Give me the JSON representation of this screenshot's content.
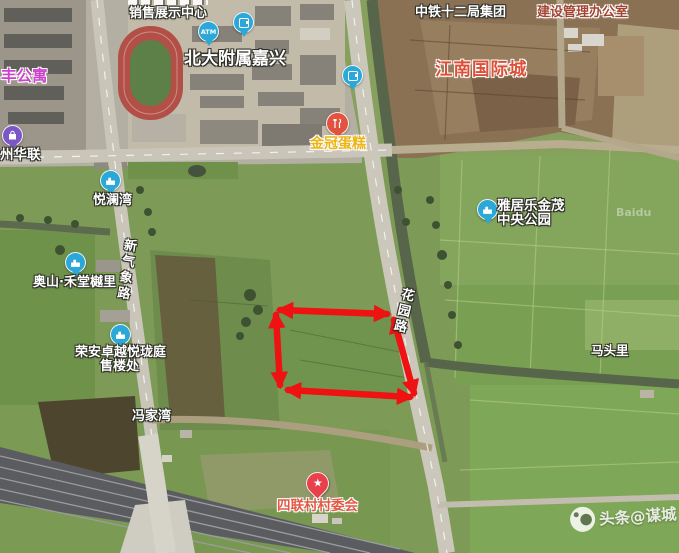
{
  "map": {
    "pois": {
      "sales_center": "销售展示中心",
      "school": "北大附属嘉兴",
      "railway_group": "中铁十二局集团",
      "management_office": "建设管理办公室",
      "jiangnan_city": "江南国际城",
      "apartment": "丰公寓",
      "hualian": "州华联",
      "yuelanwan": "悦澜湾",
      "aoshan": "奥山·禾堂樾里",
      "rongan_line1": "荣安卓越悦珑庭",
      "rongan_line2": "售楼处",
      "cake_shop": "金冠蛋糕",
      "yajule_line1": "雅居乐金茂",
      "yajule_line2": "中央公园",
      "fengjiawan": "冯家湾",
      "matouli": "马头里",
      "village_committee": "四联村村委会"
    },
    "roads": {
      "xinqixiang": "新气象路",
      "huayuan": "花园路"
    },
    "atm_label": "ATM",
    "tile_credit": "Baidu"
  },
  "annotation": {
    "shape": "quadrilateral with double-headed arrow edges",
    "color": "#ee1212",
    "corners": "274,309 392,313 417,399 281,390"
  },
  "watermark": {
    "text": "头条@谋城",
    "star_glyph": "★"
  }
}
